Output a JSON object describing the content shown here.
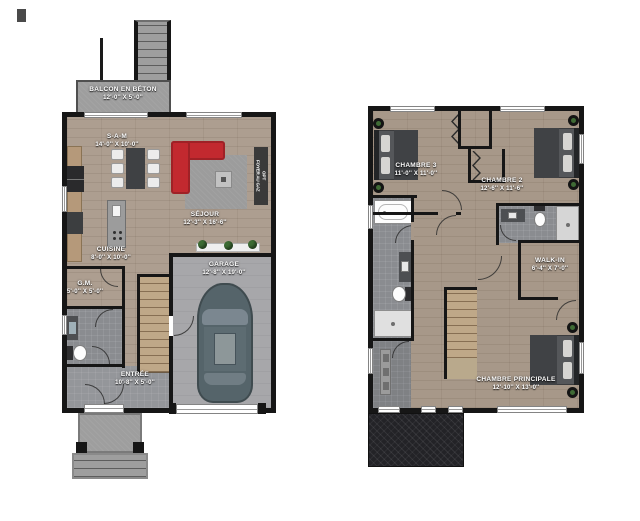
{
  "ground_floor": {
    "balcony": {
      "name": "BALCON EN BÉTON",
      "dims": "12'-0'' X 5'-0''"
    },
    "dining": {
      "name": "S-A-M",
      "dims": "14'-0'' X 10'-0''"
    },
    "living": {
      "name": "SÉJOUR",
      "dims": "12'-3'' X 16'-6''"
    },
    "fireplace": {
      "name": "FOYER AU GAZ",
      "note": "OPT"
    },
    "kitchen": {
      "name": "CUISINE",
      "dims": "8'-0'' X 10'-0''"
    },
    "pantry": {
      "name": "G.M.",
      "dims": "5'-0'' X 5'-0''"
    },
    "entry": {
      "name": "ENTRÉE",
      "dims": "10'-8'' X 5'-0''"
    },
    "garage": {
      "name": "GARAGE",
      "dims": "12'-8'' X 19'-0''"
    }
  },
  "upper_floor": {
    "bedroom3": {
      "name": "CHAMBRE 3",
      "dims": "11'-0'' X 11'-0''"
    },
    "bedroom2": {
      "name": "CHAMBRE 2",
      "dims": "12'-6'' X 11'-6''"
    },
    "walk_in": {
      "name": "WALK-IN",
      "dims": "6'-4'' X 7'-0''"
    },
    "master": {
      "name": "CHAMBRE PRINCIPALE",
      "dims": "12'-10'' X 13'-0''"
    }
  },
  "colors": {
    "wall": "#161616",
    "wood_ground": "#ad9e90",
    "wood_upper": "#a79889",
    "garage_floor": "#a7a7aa",
    "concrete": "#9e9e9e",
    "tile": "#8a8c90",
    "sofa_red": "#c2292f",
    "rug": "#9c9c9c",
    "car": "#55646a",
    "roof": "#232327",
    "label_text": "#ffffff"
  }
}
